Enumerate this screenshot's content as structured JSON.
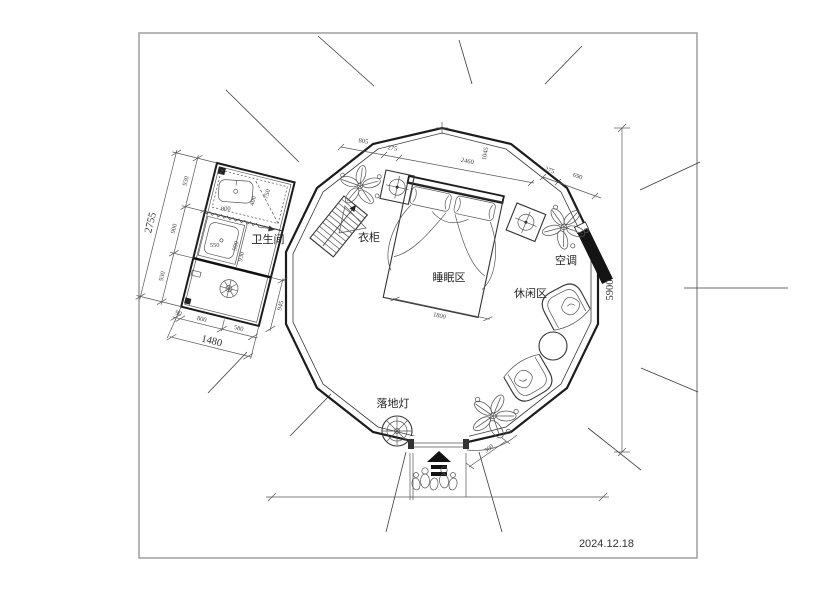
{
  "title_block": {
    "date": "2024.12.18"
  },
  "labels": {
    "bathroom": "卫生间",
    "wardrobe": "衣柜",
    "sleeping_area": "睡眠区",
    "leisure_area": "休闲区",
    "air_conditioner": "空调",
    "floor_lamp": "落地灯"
  },
  "dimensions": {
    "top_chain": [
      "805",
      "275",
      "2460",
      "1045",
      "275",
      "690"
    ],
    "bathroom_left_chain": [
      "930",
      "900",
      "930"
    ],
    "bathroom_left_total": "2755",
    "bathroom_bottom_chain": [
      "90",
      "800",
      "580"
    ],
    "bathroom_bottom_total": "1480",
    "bathroom_right": "945",
    "bathroom_interior": [
      "800",
      "750",
      "400",
      "550",
      "900",
      "930"
    ],
    "bed_width": "1800",
    "overall_height": "5900",
    "entrance_door": "360"
  },
  "colors": {
    "line": "#3a3a3a",
    "wall": "#1c1c1c",
    "frame": "#9e9e9e",
    "solid_fill": "#141414",
    "background": "#ffffff"
  }
}
